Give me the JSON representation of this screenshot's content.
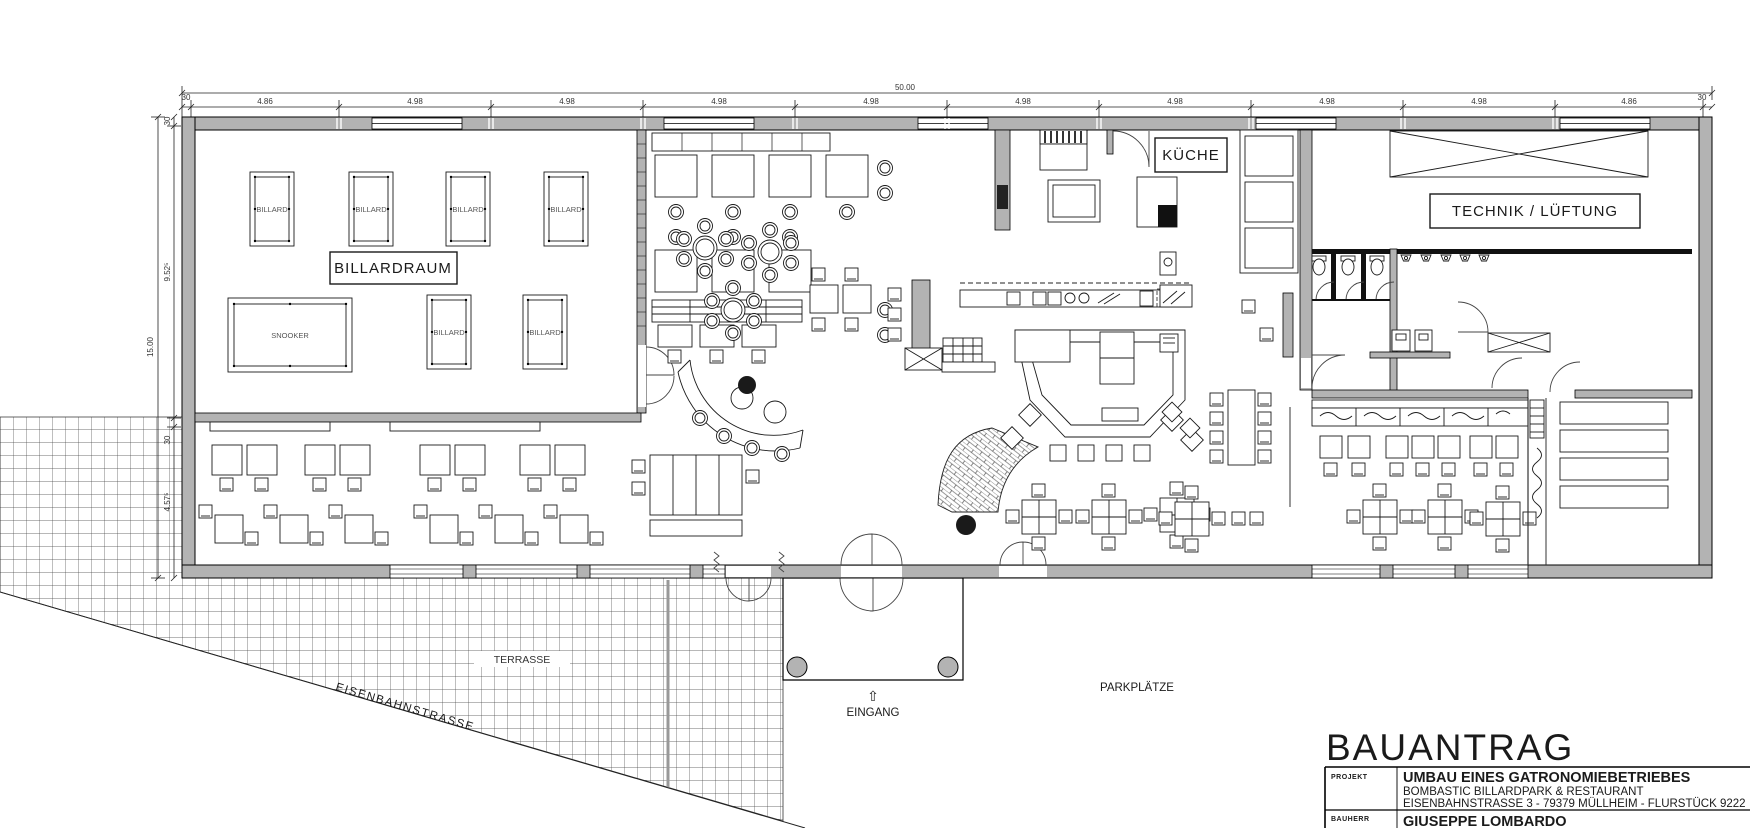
{
  "drawing": {
    "title": "BAUANTRAG",
    "rooms": {
      "billardraum": "BILLARDRAUM",
      "kueche": "KÜCHE",
      "technik": "TECHNIK / LÜFTUNG"
    },
    "furniture": {
      "billard": "BILLARD",
      "snooker": "SNOOKER"
    },
    "site": {
      "terrasse": "TERRASSE",
      "eingang": "EINGANG",
      "eingang_arrow": "⇧",
      "parkplaetze": "PARKPLÄTZE",
      "strasse": "EISENBAHNSTRASSE"
    },
    "dims": {
      "total_width": "50.00",
      "total_height": "15.00",
      "top": [
        "30",
        "4.86",
        "4.98",
        "4.98",
        "4.98",
        "4.98",
        "4.98",
        "4.98",
        "4.98",
        "4.98",
        "4.86",
        "30"
      ],
      "left": [
        "30",
        "9.52⁵",
        "30",
        "4.57⁵"
      ]
    },
    "titleblock": {
      "projekt_label": "PROJEKT",
      "projekt": "UMBAU EINES GATRONOMIEBETRIEBES",
      "line2": "BOMBASTIC BILLARDPARK & RESTAURANT",
      "line3": "EISENBAHNSTRASSE 3 - 79379 MÜLLHEIM - FLURSTÜCK 9222",
      "bauherr_label": "BAUHERR",
      "bauherr": "GIUSEPPE LOMBARDO"
    },
    "colors": {
      "wall": "#b3b3b3",
      "line": "#1a1a1a"
    }
  }
}
